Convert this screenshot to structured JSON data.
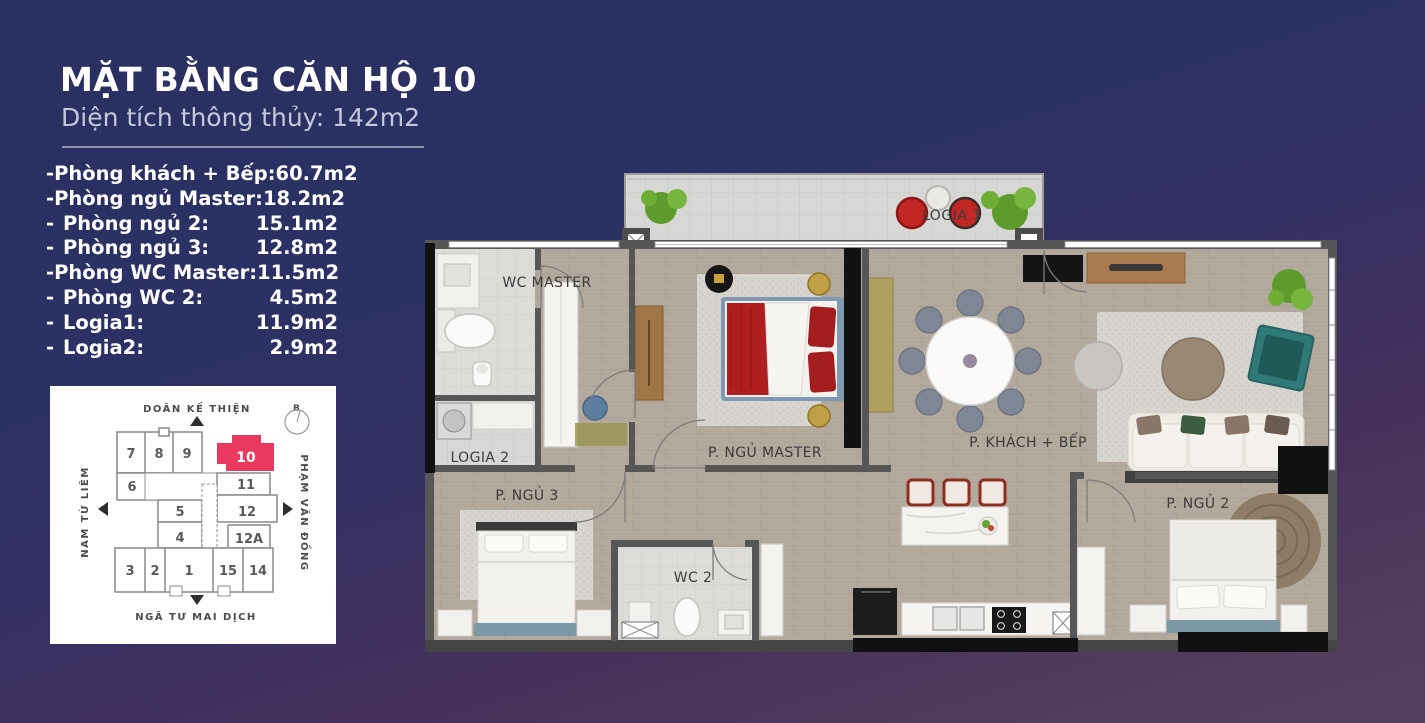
{
  "header": {
    "title": "MẶT BẰNG CĂN HỘ 10",
    "subtitle": "Diện tích thông thủy: 142m2"
  },
  "room_list": {
    "bullet": "-",
    "items": [
      {
        "label": "Phòng khách + Bếp:",
        "area": "60.7m2"
      },
      {
        "label": "Phòng ngủ Master:",
        "area": "18.2m2"
      },
      {
        "label": "Phòng ngủ 2:",
        "area": "15.1m2"
      },
      {
        "label": "Phòng ngủ 3:",
        "area": "12.8m2"
      },
      {
        "label": "Phòng WC Master:",
        "area": "11.5m2"
      },
      {
        "label": "Phòng WC 2:",
        "area": "4.5m2"
      },
      {
        "label": "Logia1:",
        "area": "11.9m2"
      },
      {
        "label": "Logia2:",
        "area": "2.9m2"
      }
    ]
  },
  "site_map": {
    "streets": {
      "top": "DOÃN KẾ THIỆN",
      "left": "NAM TỪ LIÊM",
      "right": "PHẠM VĂN ĐỒNG",
      "bottom": "NGÃ TƯ MAI DỊCH"
    },
    "compass": "B",
    "highlight_unit": "10",
    "units": {
      "u7": "7",
      "u8": "8",
      "u9": "9",
      "u10": "10",
      "u6": "6",
      "u11": "11",
      "u5": "5",
      "u12": "12",
      "u4": "4",
      "u12a": "12A",
      "u3": "3",
      "u2": "2",
      "u1": "1",
      "u15": "15",
      "u14": "14"
    }
  },
  "floorplan": {
    "labels": {
      "logia1": "LOGIA 1",
      "wc_master": "WC MASTER",
      "logia2": "LOGIA 2",
      "ngu_master": "P. NGỦ MASTER",
      "khach_bep": "P. KHÁCH + BẾP",
      "ngu3": "P. NGỦ 3",
      "wc2": "WC 2",
      "ngu2": "P. NGỦ 2"
    }
  },
  "colors": {
    "accent_red": "#e9395e",
    "bg_top": "#2a3061",
    "bg_bottom": "#57405f",
    "wall": "#565656",
    "wood_floor": "#b3a99d"
  }
}
